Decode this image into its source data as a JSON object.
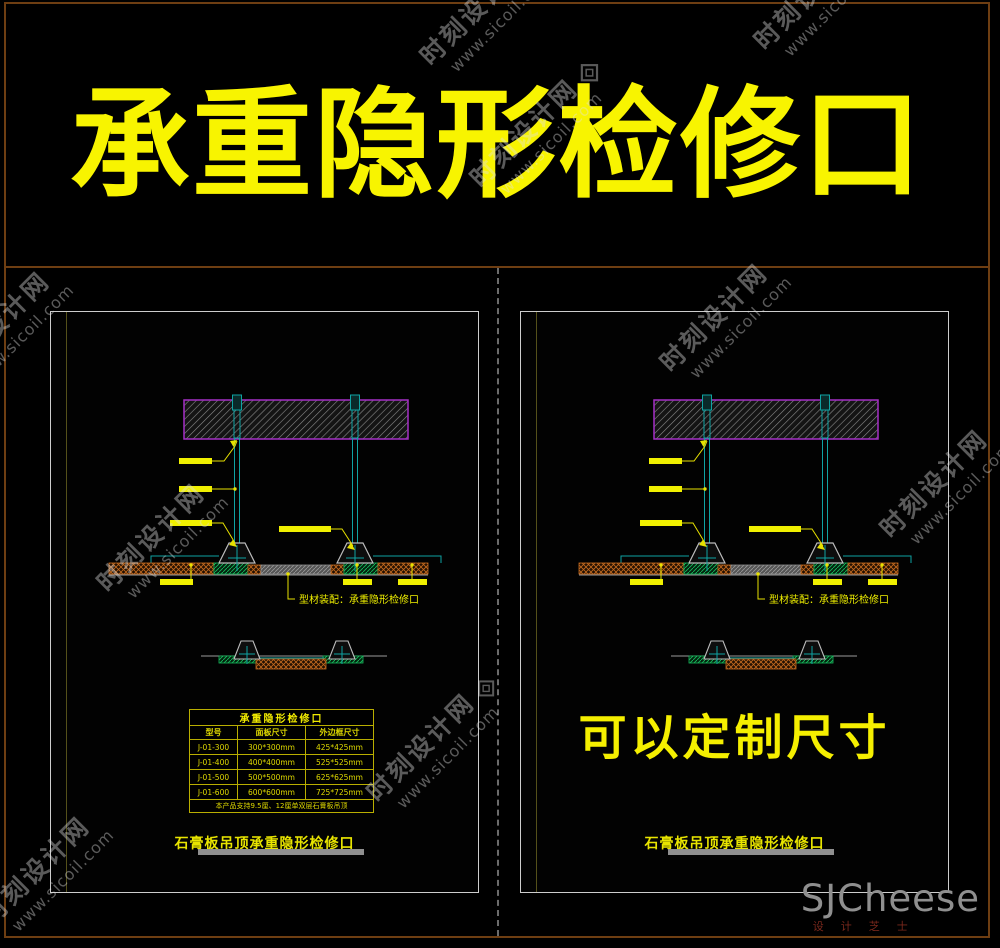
{
  "banner": {
    "title": "承重隐形检修口"
  },
  "drawing": {
    "callout": "型材装配：承重隐形检修口",
    "parts": [
      "concrete-slab",
      "hanger-rod",
      "hanger-bracket",
      "gypsum-board",
      "access-panel-frame"
    ]
  },
  "left_panel": {
    "table": {
      "title": "承重隐形检修口",
      "headers": [
        "型号",
        "面板尺寸",
        "外边框尺寸"
      ],
      "rows": [
        [
          "J-01-300",
          "300*300mm",
          "425*425mm"
        ],
        [
          "J-01-400",
          "400*400mm",
          "525*525mm"
        ],
        [
          "J-01-500",
          "500*500mm",
          "625*625mm"
        ],
        [
          "J-01-600",
          "600*600mm",
          "725*725mm"
        ]
      ],
      "note": "本产品支持9.5厘、12厘单双层石膏板吊顶"
    },
    "caption": "石膏板吊顶承重隐形检修口"
  },
  "right_panel": {
    "custom_text": "可以定制尺寸",
    "caption": "石膏板吊顶承重隐形检修口"
  },
  "watermark": {
    "site": "时刻设计网",
    "url": "www.sicoil.com"
  },
  "logo": {
    "name": "SJCheese",
    "subtitle": "设计芝士"
  },
  "colors": {
    "banner_yellow": "#f8f400",
    "frame_maroon": "#6e3e12",
    "panel_border": "#cdcdcd",
    "cad_teal": "#0fa3a3",
    "slab_purple": "#a52fc6",
    "hatch_orange": "#c46a1e",
    "hatch_green": "#17b95c",
    "label_yellow": "#f0f000",
    "caption_bar_gray": "#8f8f8f",
    "logo_gray": "#8f8f8f",
    "logo_red": "#79281c"
  }
}
